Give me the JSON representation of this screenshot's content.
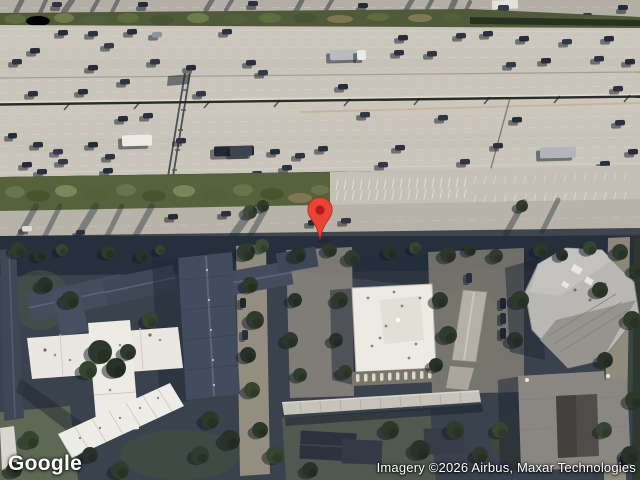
{
  "watermark": {
    "logo_text": "Google"
  },
  "attribution": {
    "text": "Imagery ©2026 Airbus, Maxar Technologies"
  },
  "marker": {
    "name": "dropped-pin",
    "body_color": "#EA4335",
    "dot_color": "#B31412"
  },
  "scene": {
    "palette": {
      "freeway_concrete": "#c9c5ba",
      "frontage_road": "#b7b3a8",
      "top_road": "#b3afa5",
      "green_strip": "#55623c",
      "tree_dark": "#2c3829",
      "shadow_blue": "#222b38",
      "apartment_roof": "#434c5e",
      "white_roof": "#e9e7e0",
      "office_roof": "#eceae2",
      "gray_building": "#b9b7b3",
      "dark_building": "#8a8681"
    },
    "top_road_cars": [
      [
        52,
        2,
        10,
        5,
        "#2e3442"
      ],
      [
        138,
        2,
        10,
        5,
        "#262b38"
      ],
      [
        248,
        1,
        10,
        5,
        "#2a3040"
      ],
      [
        358,
        3,
        10,
        5,
        "#262b38"
      ],
      [
        498,
        5,
        11,
        6,
        "#333a49"
      ],
      [
        618,
        5,
        10,
        5,
        "#262b38"
      ],
      [
        583,
        13,
        9,
        5,
        "#2a3040"
      ]
    ],
    "freeway_cars": [
      [
        58,
        30,
        10,
        5.5,
        "#262b38"
      ],
      [
        88,
        31,
        10,
        5.5,
        "#2e3442"
      ],
      [
        127,
        29,
        10,
        5.5,
        "#262b38"
      ],
      [
        152,
        32,
        10,
        5.5,
        "#8e949e"
      ],
      [
        222,
        29,
        10,
        5.5,
        "#2a3040"
      ],
      [
        104,
        43,
        10,
        5.5,
        "#333a49"
      ],
      [
        30,
        48,
        10,
        5.5,
        "#262b38"
      ],
      [
        12,
        59,
        10,
        5.5,
        "#2a3040"
      ],
      [
        88,
        65,
        10,
        5.5,
        "#262b38"
      ],
      [
        150,
        59,
        10,
        5.5,
        "#31384a"
      ],
      [
        186,
        65,
        10,
        5.5,
        "#262b38"
      ],
      [
        246,
        60,
        10,
        5.5,
        "#2a3040"
      ],
      [
        258,
        70,
        10,
        5.5,
        "#333a49"
      ],
      [
        120,
        79,
        10,
        5.5,
        "#2e3442"
      ],
      [
        78,
        89,
        10,
        5.5,
        "#262b38"
      ],
      [
        28,
        91,
        10,
        5.5,
        "#2a3040"
      ],
      [
        196,
        91,
        10,
        5.5,
        "#31384a"
      ],
      [
        338,
        84,
        10,
        5.5,
        "#262b38"
      ],
      [
        398,
        35,
        10,
        5.5,
        "#262b38"
      ],
      [
        456,
        33,
        10,
        5.5,
        "#2e3442"
      ],
      [
        483,
        31,
        10,
        5.5,
        "#2a3040"
      ],
      [
        519,
        36,
        10,
        5.5,
        "#262b38"
      ],
      [
        562,
        39,
        10,
        5.5,
        "#31384a"
      ],
      [
        604,
        36,
        10,
        5.5,
        "#262b38"
      ],
      [
        427,
        51,
        10,
        5.5,
        "#2e3442"
      ],
      [
        394,
        50,
        10,
        5.5,
        "#2a3040"
      ],
      [
        506,
        62,
        10,
        5.5,
        "#333a49"
      ],
      [
        541,
        58,
        10,
        5.5,
        "#262b38"
      ],
      [
        594,
        56,
        10,
        5.5,
        "#2a3040"
      ],
      [
        625,
        59,
        10,
        5.5,
        "#262b38"
      ],
      [
        613,
        86,
        10,
        5.5,
        "#2a3040"
      ],
      [
        330,
        50,
        30,
        10,
        "#b8bbc0"
      ],
      [
        357,
        50,
        9,
        10,
        "#e9e9e7"
      ],
      [
        118,
        116,
        10,
        5.5,
        "#262b38"
      ],
      [
        143,
        113,
        10,
        5.5,
        "#2a3040"
      ],
      [
        360,
        112,
        10,
        5.5,
        "#31384a"
      ],
      [
        438,
        115,
        10,
        5.5,
        "#2e3442"
      ],
      [
        512,
        117,
        10,
        5.5,
        "#262b38"
      ],
      [
        615,
        120,
        10,
        5.5,
        "#2a3040"
      ],
      [
        8,
        133,
        9,
        5.5,
        "#262b38"
      ],
      [
        33,
        142,
        10,
        5.5,
        "#2a3040"
      ],
      [
        53,
        149,
        10,
        5.5,
        "#31384a"
      ],
      [
        88,
        142,
        10,
        5.5,
        "#262b38"
      ],
      [
        105,
        154,
        10,
        5.5,
        "#2e3442"
      ],
      [
        22,
        162,
        10,
        5.5,
        "#262b38"
      ],
      [
        37,
        169,
        10,
        5.5,
        "#2a3040"
      ],
      [
        58,
        159,
        10,
        5.5,
        "#31384a"
      ],
      [
        103,
        168,
        10,
        5.5,
        "#262b38"
      ],
      [
        176,
        138,
        10,
        5.5,
        "#2a3040"
      ],
      [
        270,
        149,
        10,
        5.5,
        "#262b38"
      ],
      [
        295,
        153,
        10,
        5.5,
        "#2e3442"
      ],
      [
        318,
        146,
        10,
        5.5,
        "#2a3040"
      ],
      [
        378,
        162,
        10,
        5.5,
        "#31384a"
      ],
      [
        395,
        145,
        10,
        5.5,
        "#2a3040"
      ],
      [
        432,
        170,
        10,
        5.5,
        "#262b38"
      ],
      [
        493,
        143,
        10,
        5.5,
        "#2a3040"
      ],
      [
        628,
        149,
        10,
        5.5,
        "#262b38"
      ],
      [
        600,
        161,
        10,
        5.5,
        "#2a3040"
      ],
      [
        460,
        159,
        10,
        5.5,
        "#2e3442"
      ],
      [
        508,
        171,
        10,
        5.5,
        "#262b38"
      ],
      [
        282,
        165,
        10,
        5.5,
        "#2a3040"
      ],
      [
        252,
        171,
        10,
        5.5,
        "#31384a"
      ],
      [
        122,
        135,
        30,
        11,
        "#eceae4"
      ],
      [
        214,
        146,
        40,
        10,
        "#232833"
      ],
      [
        230,
        146,
        22,
        10,
        "#3d4450"
      ],
      [
        540,
        147,
        36,
        11,
        "#b2b6ba"
      ]
    ],
    "frontage_cars": [
      [
        168,
        214,
        10,
        5.5,
        "#262b38"
      ],
      [
        221,
        211,
        10,
        5.5,
        "#2a3040"
      ],
      [
        308,
        220,
        10,
        5.5,
        "#262b38"
      ],
      [
        341,
        218,
        10,
        5.5,
        "#2e3442"
      ],
      [
        22,
        226,
        10,
        5.5,
        "#dbdad6"
      ],
      [
        76,
        230,
        9,
        5,
        "#2a3040"
      ]
    ],
    "lot_cars": [
      [
        500,
        298,
        6,
        11,
        "#1f2530"
      ],
      [
        500,
        313,
        6,
        11,
        "#272d3a"
      ],
      [
        500,
        328,
        6,
        11,
        "#1f2530"
      ],
      [
        466,
        273,
        6,
        10,
        "#272d3a"
      ],
      [
        240,
        298,
        6,
        10,
        "#20262f"
      ],
      [
        242,
        330,
        6,
        10,
        "#272d3a"
      ],
      [
        620,
        455,
        7,
        12,
        "#1e242e"
      ]
    ],
    "frontage_streaks": [
      [
        36,
        206,
        16,
        242,
        6
      ],
      [
        60,
        206,
        42,
        242,
        5
      ],
      [
        96,
        206,
        74,
        242,
        7
      ],
      [
        122,
        206,
        104,
        242,
        5
      ],
      [
        152,
        206,
        132,
        242,
        6
      ],
      [
        250,
        212,
        228,
        243,
        8
      ],
      [
        266,
        208,
        246,
        243,
        6
      ],
      [
        524,
        202,
        506,
        234,
        6
      ],
      [
        558,
        200,
        542,
        232,
        5
      ]
    ],
    "top_streaks": [
      [
        22,
        0,
        16,
        12,
        5
      ],
      [
        46,
        0,
        40,
        13,
        4
      ],
      [
        72,
        0,
        64,
        12,
        6
      ],
      [
        98,
        0,
        92,
        11,
        4
      ],
      [
        118,
        0,
        112,
        12,
        4
      ],
      [
        212,
        0,
        206,
        10,
        5
      ],
      [
        232,
        0,
        226,
        10,
        4
      ],
      [
        302,
        0,
        296,
        11,
        5
      ],
      [
        332,
        0,
        326,
        10,
        4
      ],
      [
        412,
        0,
        406,
        10,
        5
      ],
      [
        432,
        0,
        427,
        9,
        4
      ],
      [
        455,
        0,
        446,
        20,
        6
      ],
      [
        470,
        2,
        462,
        18,
        4
      ]
    ],
    "parking_rows": [
      {
        "y": 180,
        "x1": 338,
        "x2": 466,
        "step": 8,
        "len": 10,
        "op": 0.75
      },
      {
        "y": 191,
        "x1": 338,
        "x2": 466,
        "step": 8,
        "len": 10,
        "op": 0.7
      },
      {
        "y": 195,
        "x1": 476,
        "x2": 634,
        "step": 10,
        "len": 8,
        "op": 0.5
      },
      {
        "y": 176,
        "x1": 476,
        "x2": 634,
        "step": 10,
        "len": 8,
        "op": 0.4
      }
    ],
    "trees": [
      [
        18,
        250,
        8,
        "#2f3b2c"
      ],
      [
        40,
        255,
        7,
        "#27332a"
      ],
      [
        62,
        250,
        6,
        "#35452f"
      ],
      [
        108,
        252,
        7,
        "#2c3829"
      ],
      [
        142,
        256,
        6,
        "#27332a"
      ],
      [
        160,
        250,
        5,
        "#35452f"
      ],
      [
        246,
        252,
        9,
        "#2f3b2c"
      ],
      [
        262,
        246,
        7,
        "#3d4c35"
      ],
      [
        298,
        255,
        8,
        "#27332a"
      ],
      [
        330,
        250,
        7,
        "#2c3829"
      ],
      [
        352,
        258,
        8,
        "#2f3b2c"
      ],
      [
        390,
        252,
        7,
        "#27332a"
      ],
      [
        415,
        248,
        6,
        "#35452f"
      ],
      [
        448,
        255,
        8,
        "#2c3829"
      ],
      [
        470,
        250,
        6,
        "#27332a"
      ],
      [
        496,
        256,
        7,
        "#2f3b2c"
      ],
      [
        540,
        250,
        7,
        "#2c3829"
      ],
      [
        562,
        255,
        6,
        "#27332a"
      ],
      [
        590,
        248,
        7,
        "#35452f"
      ],
      [
        620,
        252,
        8,
        "#2f3b2c"
      ],
      [
        250,
        285,
        8,
        "#2c3829"
      ],
      [
        255,
        320,
        9,
        "#2f3b2c"
      ],
      [
        248,
        355,
        8,
        "#27332a"
      ],
      [
        252,
        390,
        8,
        "#35452f"
      ],
      [
        295,
        300,
        7,
        "#27332a"
      ],
      [
        290,
        340,
        8,
        "#2c3829"
      ],
      [
        300,
        375,
        7,
        "#2f3b2c"
      ],
      [
        340,
        300,
        8,
        "#2c3829"
      ],
      [
        336,
        340,
        7,
        "#27332a"
      ],
      [
        345,
        372,
        7,
        "#2f3b2c"
      ],
      [
        440,
        300,
        8,
        "#2c3829"
      ],
      [
        448,
        335,
        9,
        "#2f3b2c"
      ],
      [
        436,
        365,
        7,
        "#27332a"
      ],
      [
        520,
        300,
        9,
        "#2c3829"
      ],
      [
        515,
        340,
        8,
        "#27332a"
      ],
      [
        100,
        352,
        12,
        "#2c3829"
      ],
      [
        116,
        368,
        10,
        "#27332a"
      ],
      [
        88,
        370,
        9,
        "#35452f"
      ],
      [
        128,
        352,
        8,
        "#2f3b2c"
      ],
      [
        70,
        300,
        9,
        "#2c3829"
      ],
      [
        45,
        285,
        8,
        "#27332a"
      ],
      [
        150,
        320,
        8,
        "#35452f"
      ],
      [
        210,
        420,
        9,
        "#2c3829"
      ],
      [
        230,
        440,
        10,
        "#27332a"
      ],
      [
        200,
        455,
        9,
        "#2f3b2c"
      ],
      [
        260,
        430,
        8,
        "#2c3829"
      ],
      [
        275,
        455,
        9,
        "#35452f"
      ],
      [
        390,
        430,
        9,
        "#2c3829"
      ],
      [
        420,
        450,
        10,
        "#27332a"
      ],
      [
        455,
        430,
        9,
        "#2f3b2c"
      ],
      [
        480,
        455,
        8,
        "#2c3829"
      ],
      [
        500,
        430,
        8,
        "#35452f"
      ],
      [
        310,
        470,
        8,
        "#27332a"
      ],
      [
        600,
        290,
        8,
        "#2c3829"
      ],
      [
        632,
        320,
        9,
        "#2f3b2c"
      ],
      [
        605,
        360,
        8,
        "#27332a"
      ],
      [
        634,
        400,
        9,
        "#2c3829"
      ],
      [
        604,
        430,
        8,
        "#35452f"
      ],
      [
        630,
        455,
        9,
        "#27332a"
      ],
      [
        636,
        270,
        7,
        "#2c3829"
      ],
      [
        30,
        440,
        9,
        "#35452f"
      ],
      [
        14,
        470,
        8,
        "#2c3829"
      ],
      [
        90,
        455,
        8,
        "#27332a"
      ],
      [
        120,
        470,
        9,
        "#2f3b2c"
      ],
      [
        250,
        212,
        7,
        "#3d4c35"
      ],
      [
        263,
        206,
        6,
        "#2f3b2c"
      ],
      [
        522,
        206,
        6,
        "#2f3b2c"
      ]
    ]
  }
}
